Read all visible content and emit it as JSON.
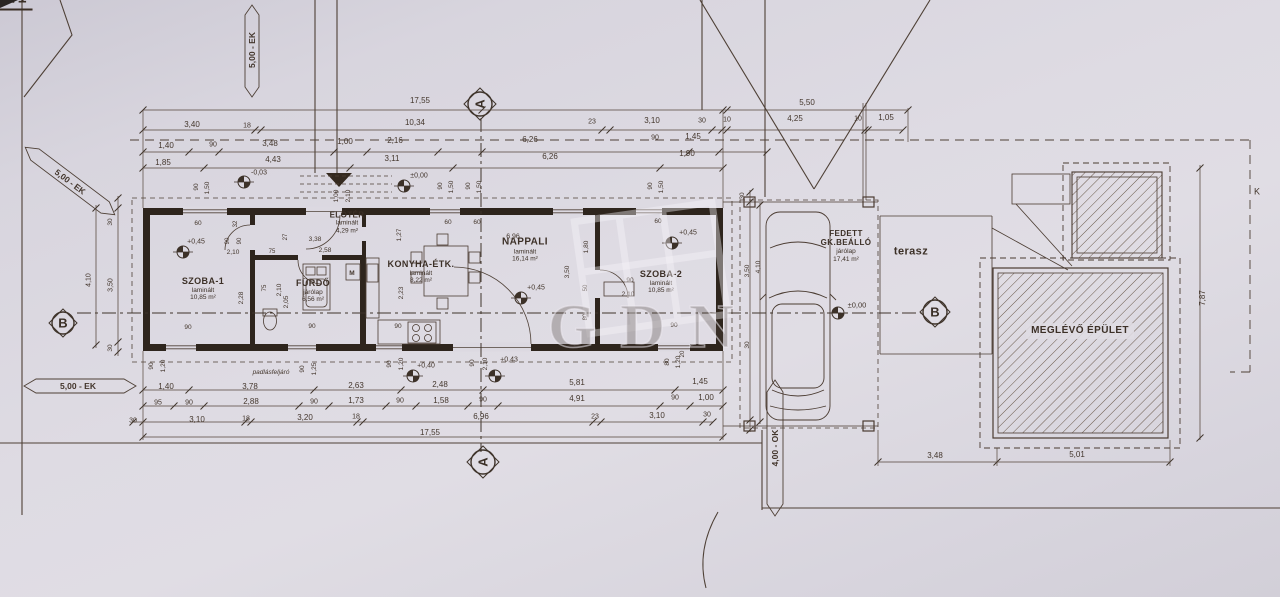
{
  "title": "4530/1",
  "watermark": "GDN",
  "rooms": [
    {
      "id": "szoba-1",
      "name": "SZOBA-1",
      "floor": "laminált",
      "area": "10,85 m²",
      "x": 203,
      "y": 289,
      "ns": 9
    },
    {
      "id": "furdo",
      "name": "FÜRDŐ",
      "floor": "járólap",
      "area": "6,56 m²",
      "x": 313,
      "y": 291,
      "ns": 9
    },
    {
      "id": "eloter",
      "name": "ELŐTÉR",
      "floor": "laminált",
      "area": "4,29 m²",
      "x": 347,
      "y": 223,
      "ns": 8
    },
    {
      "id": "konyha-etkezo",
      "name": "KONYHA-ÉTK.",
      "floor": "laminált",
      "area": "8,22 m²",
      "x": 421,
      "y": 272,
      "ns": 9
    },
    {
      "id": "nappali",
      "name": "NAPPALI",
      "floor": "laminált",
      "area": "16,14 m²",
      "x": 525,
      "y": 250,
      "ns": 10
    },
    {
      "id": "szoba-2",
      "name": "SZOBA-2",
      "floor": "laminált",
      "area": "10,85 m²",
      "x": 661,
      "y": 282,
      "ns": 9
    },
    {
      "id": "fedett-gk-beallo",
      "name": "FEDETT GK.BEÁLLÓ",
      "floor": "járólap",
      "area": "17,41 m²",
      "x": 846,
      "y": 246,
      "ns": 8,
      "wrap": 52
    },
    {
      "id": "terasz",
      "name": "terasz",
      "x": 911,
      "y": 252,
      "ns": 11
    },
    {
      "id": "meglevo-epulet",
      "name": "MEGLÉVŐ ÉPÜLET",
      "x": 1080,
      "y": 331,
      "ns": 10,
      "bg": true
    }
  ],
  "markers": [
    {
      "letter": "A",
      "x": 480,
      "y": 104,
      "r": -90
    },
    {
      "letter": "A",
      "x": 483,
      "y": 462,
      "r": -90
    },
    {
      "letter": "B",
      "x": 63,
      "y": 323,
      "r": 0
    },
    {
      "letter": "B",
      "x": 935,
      "y": 312,
      "r": 0
    }
  ],
  "annotations": [
    {
      "t": "17,55",
      "x": 420,
      "y": 101
    },
    {
      "t": "5,50",
      "x": 807,
      "y": 103
    },
    {
      "t": "3,40",
      "x": 192,
      "y": 125
    },
    {
      "t": "18",
      "x": 247,
      "y": 126,
      "s": 7
    },
    {
      "t": "10,34",
      "x": 415,
      "y": 123
    },
    {
      "t": "23",
      "x": 592,
      "y": 122,
      "s": 7
    },
    {
      "t": "3,10",
      "x": 652,
      "y": 121
    },
    {
      "t": "30",
      "x": 702,
      "y": 121,
      "s": 7
    },
    {
      "t": "10",
      "x": 727,
      "y": 120,
      "s": 7
    },
    {
      "t": "4,25",
      "x": 795,
      "y": 119
    },
    {
      "t": "10",
      "x": 858,
      "y": 119,
      "s": 7
    },
    {
      "t": "1,05",
      "x": 886,
      "y": 118
    },
    {
      "t": "1,40",
      "x": 166,
      "y": 146
    },
    {
      "t": "90",
      "x": 213,
      "y": 145,
      "s": 7
    },
    {
      "t": "3,48",
      "x": 270,
      "y": 144
    },
    {
      "t": "1,00",
      "x": 345,
      "y": 142
    },
    {
      "t": "2,16",
      "x": 395,
      "y": 141
    },
    {
      "t": "6,26",
      "x": 530,
      "y": 140
    },
    {
      "t": "90",
      "x": 655,
      "y": 138,
      "s": 7
    },
    {
      "t": "1,45",
      "x": 693,
      "y": 137
    },
    {
      "t": "1,85",
      "x": 163,
      "y": 163
    },
    {
      "t": "4,43",
      "x": 273,
      "y": 160
    },
    {
      "t": "3,11",
      "x": 392,
      "y": 159
    },
    {
      "t": "6,26",
      "x": 550,
      "y": 157
    },
    {
      "t": "1,90",
      "x": 687,
      "y": 154
    },
    {
      "t": "-0,03",
      "x": 259,
      "y": 173,
      "s": 7
    },
    {
      "t": "±0,00",
      "x": 419,
      "y": 176,
      "s": 7
    },
    {
      "t": "90",
      "x": 197,
      "y": 187,
      "r": -90,
      "s": 6.5
    },
    {
      "t": "1,50",
      "x": 208,
      "y": 188,
      "r": -90,
      "s": 6.5
    },
    {
      "t": "1,00",
      "x": 337,
      "y": 196,
      "r": -90,
      "s": 6.5
    },
    {
      "t": "2,10",
      "x": 349,
      "y": 196,
      "r": -90,
      "s": 6.5
    },
    {
      "t": "90",
      "x": 441,
      "y": 186,
      "r": -90,
      "s": 6.5
    },
    {
      "t": "1,50",
      "x": 452,
      "y": 187,
      "r": -90,
      "s": 6.5
    },
    {
      "t": "90",
      "x": 469,
      "y": 186,
      "r": -90,
      "s": 6.5
    },
    {
      "t": "1,50",
      "x": 480,
      "y": 187,
      "r": -90,
      "s": 6.5
    },
    {
      "t": "90",
      "x": 651,
      "y": 186,
      "r": -90,
      "s": 6.5
    },
    {
      "t": "1,50",
      "x": 662,
      "y": 187,
      "r": -90,
      "s": 6.5
    },
    {
      "t": "60",
      "x": 198,
      "y": 224,
      "s": 6.5
    },
    {
      "t": "32",
      "x": 236,
      "y": 224,
      "r": -90,
      "s": 6
    },
    {
      "t": "90",
      "x": 228,
      "y": 241,
      "r": -90,
      "s": 6
    },
    {
      "t": "90",
      "x": 240,
      "y": 241,
      "r": -90,
      "s": 6
    },
    {
      "t": "2,10",
      "x": 233,
      "y": 253,
      "s": 6.5
    },
    {
      "t": "27",
      "x": 286,
      "y": 237,
      "r": -90,
      "s": 6
    },
    {
      "t": "3,38",
      "x": 315,
      "y": 240,
      "s": 6.5
    },
    {
      "t": "75",
      "x": 272,
      "y": 252,
      "s": 6
    },
    {
      "t": "2,58",
      "x": 325,
      "y": 251,
      "s": 6.5
    },
    {
      "t": "2,28",
      "x": 242,
      "y": 298,
      "r": -90,
      "s": 6.5
    },
    {
      "t": "75",
      "x": 265,
      "y": 288,
      "r": -90,
      "s": 6
    },
    {
      "t": "2,10",
      "x": 280,
      "y": 290,
      "r": -90,
      "s": 6.5
    },
    {
      "t": "2,05",
      "x": 287,
      "y": 302,
      "r": -90,
      "s": 6.5
    },
    {
      "t": "90",
      "x": 188,
      "y": 328,
      "s": 6.5
    },
    {
      "t": "90",
      "x": 312,
      "y": 327,
      "s": 6.5
    },
    {
      "t": "M",
      "x": 352,
      "y": 274,
      "s": 6.5,
      "b": true
    },
    {
      "t": "60",
      "x": 448,
      "y": 223,
      "s": 6.5
    },
    {
      "t": "60",
      "x": 477,
      "y": 223,
      "s": 6.5
    },
    {
      "t": "1,27",
      "x": 400,
      "y": 235,
      "r": -90,
      "s": 6.5
    },
    {
      "t": "6,96",
      "x": 513,
      "y": 237,
      "s": 7
    },
    {
      "t": "2,23",
      "x": 402,
      "y": 293,
      "r": -90,
      "s": 6.5
    },
    {
      "t": "90",
      "x": 398,
      "y": 327,
      "s": 6.5
    },
    {
      "t": "3,50",
      "x": 568,
      "y": 272,
      "r": -90,
      "s": 6.5
    },
    {
      "t": "1,80",
      "x": 587,
      "y": 247,
      "r": -90,
      "s": 6.5
    },
    {
      "t": "60",
      "x": 658,
      "y": 222,
      "s": 6.5
    },
    {
      "t": "90",
      "x": 630,
      "y": 281,
      "s": 6.5
    },
    {
      "t": "50",
      "x": 586,
      "y": 288,
      "r": -90,
      "s": 6
    },
    {
      "t": "2,10",
      "x": 628,
      "y": 295,
      "s": 6.5
    },
    {
      "t": "80",
      "x": 586,
      "y": 317,
      "r": -90,
      "s": 6
    },
    {
      "t": "90",
      "x": 674,
      "y": 326,
      "s": 6.5
    },
    {
      "t": "20",
      "x": 683,
      "y": 354,
      "r": -90,
      "s": 6
    },
    {
      "t": "+0,45",
      "x": 196,
      "y": 242,
      "s": 7
    },
    {
      "t": "+0,45",
      "x": 536,
      "y": 288,
      "s": 7
    },
    {
      "t": "+0,45",
      "x": 688,
      "y": 233,
      "s": 7
    },
    {
      "t": "±0,00",
      "x": 857,
      "y": 305,
      "s": 7.5
    },
    {
      "t": "30",
      "x": 743,
      "y": 196,
      "r": -90,
      "s": 6.5
    },
    {
      "t": "3,50",
      "x": 748,
      "y": 271,
      "r": -90,
      "s": 6.5
    },
    {
      "t": "4,10",
      "x": 759,
      "y": 267,
      "r": -90,
      "s": 6.5
    },
    {
      "t": "30",
      "x": 748,
      "y": 345,
      "r": -90,
      "s": 6.5
    },
    {
      "t": "4,10",
      "x": 89,
      "y": 280,
      "r": -90,
      "s": 7
    },
    {
      "t": "30",
      "x": 111,
      "y": 222,
      "r": -90,
      "s": 6.5
    },
    {
      "t": "3,50",
      "x": 111,
      "y": 285,
      "r": -90,
      "s": 7
    },
    {
      "t": "30",
      "x": 111,
      "y": 348,
      "r": -90,
      "s": 6.5
    },
    {
      "t": "90",
      "x": 152,
      "y": 366,
      "r": -90,
      "s": 6.5
    },
    {
      "t": "1,20",
      "x": 164,
      "y": 366,
      "r": -90,
      "s": 6.5
    },
    {
      "t": "padlásfeljáró",
      "x": 271,
      "y": 373,
      "s": 6.5,
      "i": true
    },
    {
      "t": "90",
      "x": 303,
      "y": 369,
      "r": -90,
      "s": 6.5
    },
    {
      "t": "1,25",
      "x": 315,
      "y": 369,
      "r": -90,
      "s": 6.5
    },
    {
      "t": "90",
      "x": 390,
      "y": 364,
      "r": -90,
      "s": 6.5
    },
    {
      "t": "1,20",
      "x": 402,
      "y": 364,
      "r": -90,
      "s": 6.5
    },
    {
      "t": "+0,40",
      "x": 426,
      "y": 366,
      "s": 7
    },
    {
      "t": "90",
      "x": 473,
      "y": 363,
      "r": -90,
      "s": 6.5
    },
    {
      "t": "2,10",
      "x": 486,
      "y": 364,
      "r": -90,
      "s": 6.5
    },
    {
      "t": "+0,43",
      "x": 509,
      "y": 360,
      "s": 7
    },
    {
      "t": "80",
      "x": 668,
      "y": 362,
      "r": -90,
      "s": 6.5
    },
    {
      "t": "1,20",
      "x": 679,
      "y": 362,
      "r": -90,
      "s": 6.5
    },
    {
      "t": "1,40",
      "x": 166,
      "y": 387
    },
    {
      "t": "3,78",
      "x": 250,
      "y": 387
    },
    {
      "t": "2,63",
      "x": 356,
      "y": 386
    },
    {
      "t": "2,48",
      "x": 440,
      "y": 385
    },
    {
      "t": "5,81",
      "x": 577,
      "y": 383
    },
    {
      "t": "1,45",
      "x": 700,
      "y": 382
    },
    {
      "t": "95",
      "x": 158,
      "y": 403,
      "s": 7
    },
    {
      "t": "90",
      "x": 189,
      "y": 403,
      "s": 7
    },
    {
      "t": "2,88",
      "x": 251,
      "y": 402
    },
    {
      "t": "90",
      "x": 314,
      "y": 402,
      "s": 7
    },
    {
      "t": "1,73",
      "x": 356,
      "y": 401
    },
    {
      "t": "90",
      "x": 400,
      "y": 401,
      "s": 7
    },
    {
      "t": "1,58",
      "x": 441,
      "y": 401
    },
    {
      "t": "90",
      "x": 483,
      "y": 400,
      "s": 7
    },
    {
      "t": "4,91",
      "x": 577,
      "y": 399
    },
    {
      "t": "90",
      "x": 675,
      "y": 398,
      "s": 7
    },
    {
      "t": "1,00",
      "x": 706,
      "y": 398
    },
    {
      "t": "30",
      "x": 133,
      "y": 421,
      "s": 7
    },
    {
      "t": "3,10",
      "x": 197,
      "y": 420
    },
    {
      "t": "18",
      "x": 246,
      "y": 419,
      "s": 7
    },
    {
      "t": "3,20",
      "x": 305,
      "y": 418
    },
    {
      "t": "18",
      "x": 356,
      "y": 417,
      "s": 7
    },
    {
      "t": "6,96",
      "x": 481,
      "y": 417
    },
    {
      "t": "23",
      "x": 595,
      "y": 417,
      "s": 7
    },
    {
      "t": "3,10",
      "x": 657,
      "y": 416
    },
    {
      "t": "30",
      "x": 707,
      "y": 415,
      "s": 7
    },
    {
      "t": "17,55",
      "x": 430,
      "y": 433
    },
    {
      "t": "3,48",
      "x": 935,
      "y": 456
    },
    {
      "t": "5,01",
      "x": 1077,
      "y": 455
    },
    {
      "t": "7,87",
      "x": 1203,
      "y": 298,
      "r": -90
    },
    {
      "t": "K",
      "x": 1257,
      "y": 192,
      "s": 9
    },
    {
      "t": "5,00 - EK",
      "x": 252,
      "y": 50,
      "r": -90,
      "s": 8.5,
      "b": true
    },
    {
      "t": "5,00 - EK",
      "x": 70,
      "y": 182,
      "r": 37,
      "s": 8.5,
      "b": true
    },
    {
      "t": "5,00 - EK",
      "x": 78,
      "y": 386,
      "s": 8.5,
      "b": true
    },
    {
      "t": "4,00 - OK",
      "x": 775,
      "y": 448,
      "r": -90,
      "s": 8.5,
      "b": true
    }
  ]
}
